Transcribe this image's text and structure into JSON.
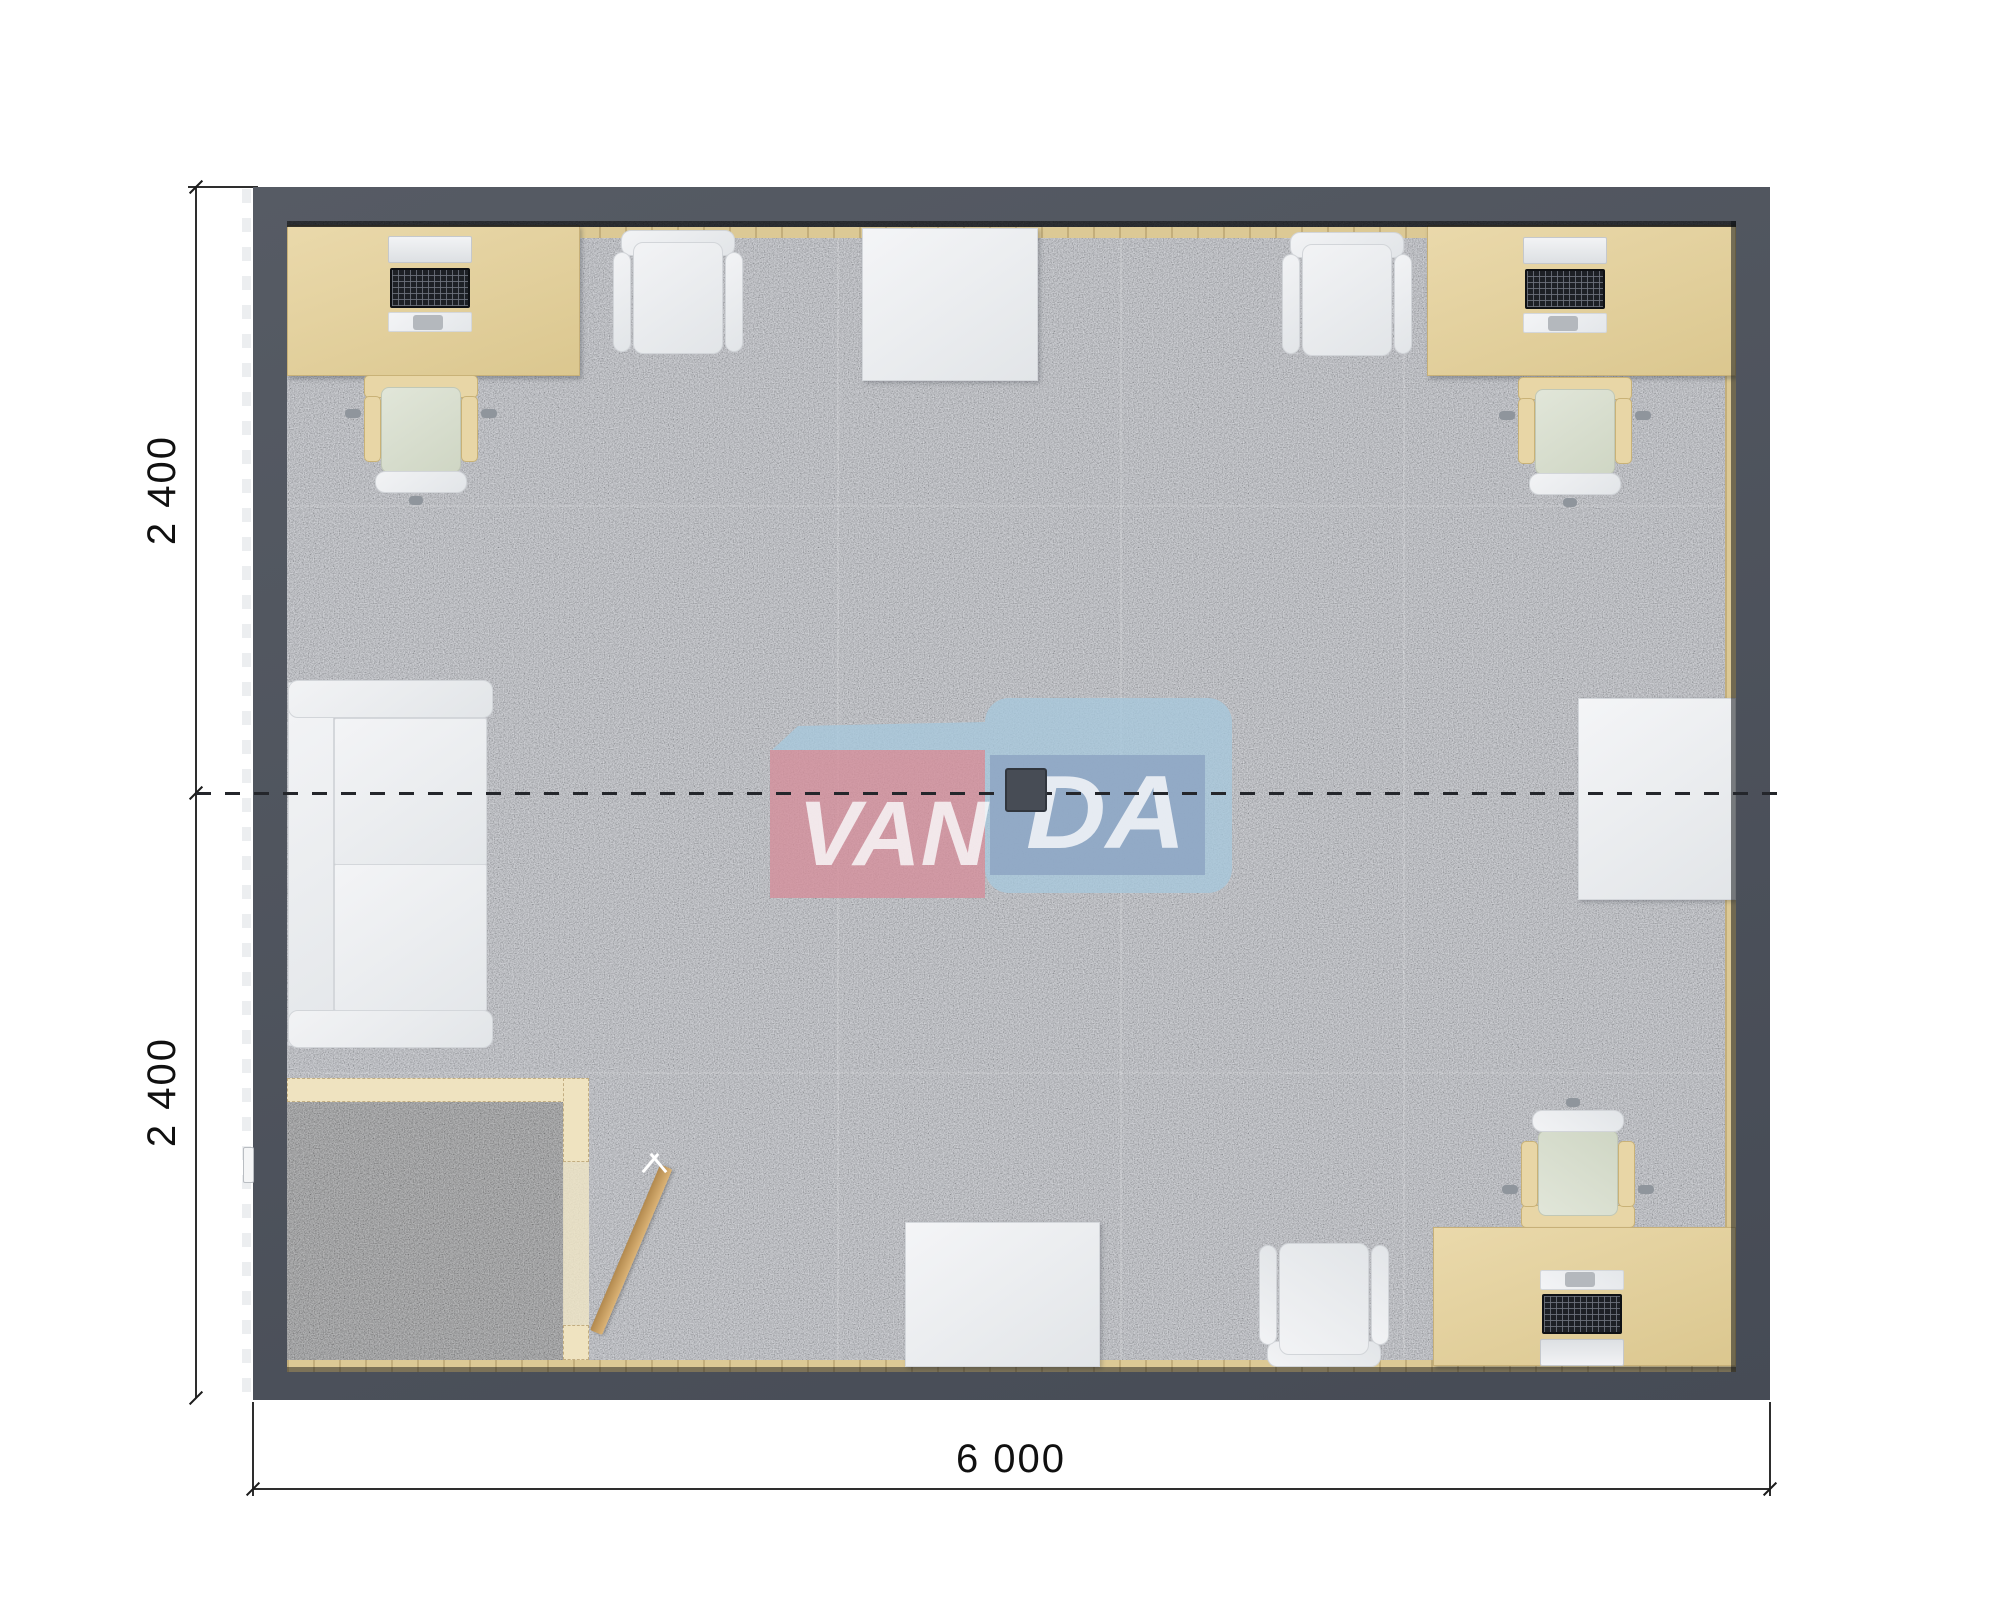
{
  "page": {
    "background": "#ffffff",
    "type": "floor-plan-render"
  },
  "dimensions": {
    "left": {
      "labels": [
        "2 400",
        "2 400"
      ]
    },
    "bottom": {
      "label": "6 000"
    }
  },
  "watermark": {
    "left_text": "VAN",
    "right_text": "DA",
    "pink": "#d58f9b",
    "light_blue": "#a7c8dd",
    "dark_blue": "#8ca3c2",
    "text_color": "#fbfcfd"
  },
  "floorplan": {
    "colors": {
      "wall": "#4d525c",
      "floor": "#b9bcc4",
      "vestibule_floor": "#8d8e90",
      "wood": "#e3d2a2",
      "wood_light": "#efe3c0",
      "strip": "#dcc995",
      "door_wood": "#c9a066",
      "lamp": "#474c55",
      "dim_line": "#2e2e2e"
    },
    "room": {
      "x": 253,
      "y": 187,
      "w": 1517,
      "h": 1213,
      "wall_top": 34,
      "wall_left": 34,
      "wall_right": 34,
      "wall_bottom": 28
    },
    "floor_rect": {
      "x": 287,
      "y": 221,
      "w": 1449,
      "h": 1151
    },
    "section_line": {
      "y": 792,
      "x1": 196,
      "x2": 1790
    },
    "dim_left": {
      "x": 196,
      "y1": 187,
      "y_mid": 793,
      "y2": 1398,
      "label_centers": [
        [
          162,
          490
        ],
        [
          162,
          1092
        ]
      ]
    },
    "dim_bottom": {
      "y": 1489,
      "x1": 253,
      "x2": 1770,
      "label_center": [
        1011,
        1459
      ],
      "ext_y1": 1402,
      "ext_y2": 1496
    },
    "cladding_dashes": {
      "x": 242,
      "y": 189,
      "w": 9,
      "h": 1209
    },
    "entry_handle": {
      "x": 243,
      "y": 1147,
      "w": 9,
      "h": 34
    },
    "lamp": {
      "x": 1005,
      "y": 768,
      "w": 42,
      "h": 44
    },
    "seams": {
      "vertical": [
        550,
        833,
        1116
      ],
      "horizontal": [
        284,
        851
      ]
    },
    "strips": {
      "top": [
        0,
        6,
        1449,
        11
      ],
      "right": [
        1438,
        6,
        11,
        1139
      ],
      "bottom": [
        0,
        1139,
        1449,
        12
      ]
    },
    "shadows": {
      "top": [
        0,
        0,
        1449,
        6,
        0.8
      ],
      "right": [
        1444,
        0,
        5,
        1151,
        0.5
      ],
      "bottom": [
        0,
        1146,
        1449,
        5,
        0.45
      ]
    },
    "vestibule": {
      "carpet": [
        0,
        879,
        277,
        260
      ],
      "partition_top": [
        0,
        857,
        284,
        24
      ],
      "partition_right_upper": [
        276,
        857,
        26,
        84
      ],
      "threshold": [
        276,
        941,
        26,
        163
      ],
      "partition_right_lower": [
        276,
        1104,
        26,
        35
      ],
      "door": {
        "x": 303,
        "y": 929,
        "w": 13,
        "h": 180,
        "angle": 23
      },
      "swing_mark": {
        "x": 362,
        "y": 930
      }
    },
    "furniture": [
      {
        "id": "desk-top-left",
        "type": "desk",
        "x": 0,
        "y": 4,
        "w": 293,
        "h": 151
      },
      {
        "id": "computer-top-left",
        "type": "computer",
        "x": 101,
        "y": 15,
        "flip": false
      },
      {
        "id": "desk-chair-top-left",
        "type": "desk_chair",
        "x": 58,
        "y": 154,
        "flip": false
      },
      {
        "id": "office-chair-top-1",
        "type": "office_chair",
        "x": 326,
        "y": 9,
        "flip": false
      },
      {
        "id": "table-top",
        "type": "table",
        "x": 575,
        "y": 7,
        "w": 176,
        "h": 153
      },
      {
        "id": "office-chair-top-2",
        "type": "office_chair",
        "x": 995,
        "y": 11,
        "flip": false
      },
      {
        "id": "desk-top-right",
        "type": "desk",
        "x": 1140,
        "y": 4,
        "w": 309,
        "h": 151
      },
      {
        "id": "computer-top-right",
        "type": "computer",
        "x": 1236,
        "y": 16,
        "flip": false
      },
      {
        "id": "desk-chair-top-right",
        "type": "desk_chair",
        "x": 1212,
        "y": 156,
        "flip": false
      },
      {
        "id": "table-right",
        "type": "table",
        "x": 1291,
        "y": 477,
        "w": 158,
        "h": 202
      },
      {
        "id": "sofa",
        "type": "sofa",
        "x": 1,
        "y": 459,
        "w": 205,
        "h": 368
      },
      {
        "id": "desk-chair-bottom-right",
        "type": "desk_chair",
        "x": 1215,
        "y": 877,
        "flip": true
      },
      {
        "id": "desk-bottom-right",
        "type": "desk",
        "x": 1146,
        "y": 1006,
        "w": 303,
        "h": 139
      },
      {
        "id": "computer-bottom-right",
        "type": "computer",
        "x": 1253,
        "y": 1041,
        "flip": true
      },
      {
        "id": "office-chair-bottom",
        "type": "office_chair",
        "x": 972,
        "y": 1018,
        "flip": true
      },
      {
        "id": "table-bottom",
        "type": "table",
        "x": 618,
        "y": 1001,
        "w": 195,
        "h": 145
      }
    ]
  }
}
